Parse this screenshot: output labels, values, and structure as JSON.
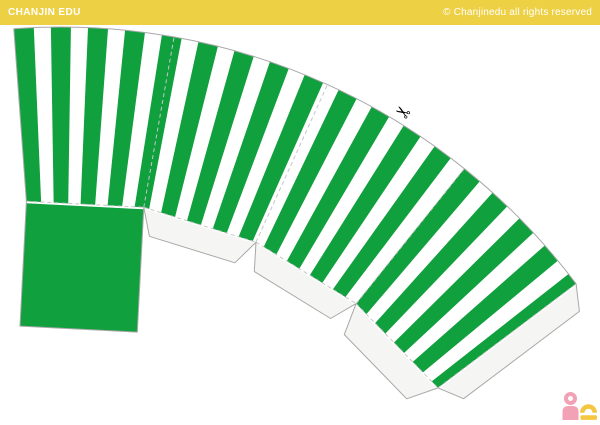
{
  "header": {
    "brand": "CHANJIN EDU",
    "copyright": "© Chanjinedu all rights reserved",
    "bg": "#EDD044",
    "text_color": "#FFFFFF"
  },
  "template": {
    "colors": {
      "stripe_green": "#10A03E",
      "paper_white": "#FFFFFF",
      "flap_fill": "#F5F6F3",
      "cut_line": "#A8A8A8",
      "fold_line": "#C6C6C6"
    },
    "fan": {
      "cx": 61,
      "cy": 672,
      "r_inner": 472,
      "r_outer": 645,
      "start_angle_deg": -4.2,
      "panel_angle_deg": 14.3,
      "panel_count": 4
    },
    "stripes": {
      "pair_angle_deg": 3.3,
      "green_angle_deg": 1.78
    },
    "base_square": {
      "depth": 125,
      "gap": 2
    },
    "bottom_flaps": {
      "depths": [
        26,
        26,
        30
      ],
      "bevel": 14,
      "gap": 1.5
    },
    "side_flap": {
      "depth": 24,
      "bevel": 14,
      "gap": 1.5
    },
    "scissors": {
      "glyph": "✂",
      "angle_on_arc_deg": 31.4,
      "radius": 657,
      "rotation_deg": 212,
      "size": 18,
      "color": "#000000"
    }
  },
  "logo": {
    "pink": "#F3A1B5",
    "yellow": "#F5C63F"
  }
}
